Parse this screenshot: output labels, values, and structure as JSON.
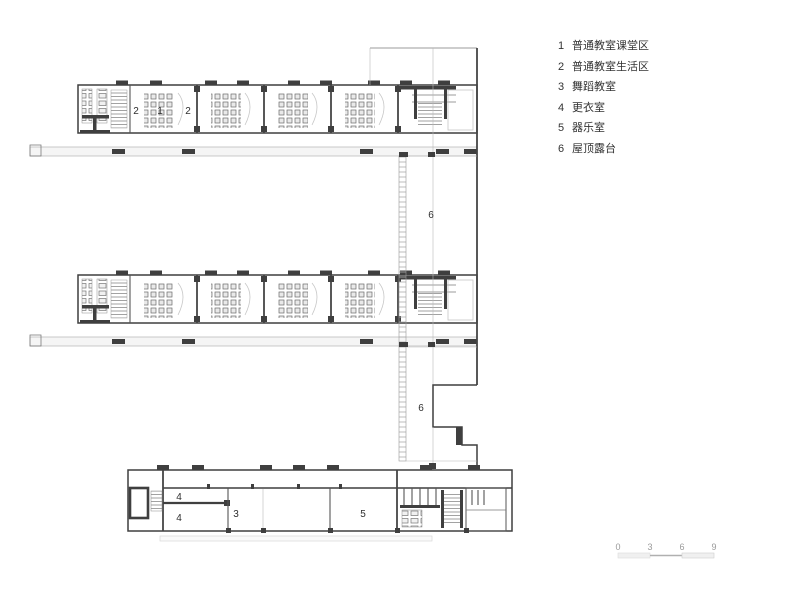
{
  "legend": {
    "items": [
      {
        "num": "1",
        "label": "普通教室课堂区"
      },
      {
        "num": "2",
        "label": "普通教室生活区"
      },
      {
        "num": "3",
        "label": "舞蹈教室"
      },
      {
        "num": "4",
        "label": "更衣室"
      },
      {
        "num": "5",
        "label": "器乐室"
      },
      {
        "num": "6",
        "label": "屋顶露台"
      }
    ]
  },
  "plan": {
    "labels": {
      "wing_living_left": "2",
      "wing_classroom": "1",
      "wing_living_right": "2",
      "terrace_upper": "6",
      "terrace_lower": "6",
      "changing_upper": "4",
      "changing_lower": "4",
      "dance": "3",
      "music": "5"
    }
  },
  "scale_bar": {
    "ticks": [
      "0",
      "3",
      "6",
      "9"
    ]
  },
  "colors": {
    "line": "#3f3f3f",
    "light": "#f3f3f3",
    "text": "#2f2f2f",
    "muted": "#9a9a9a"
  }
}
